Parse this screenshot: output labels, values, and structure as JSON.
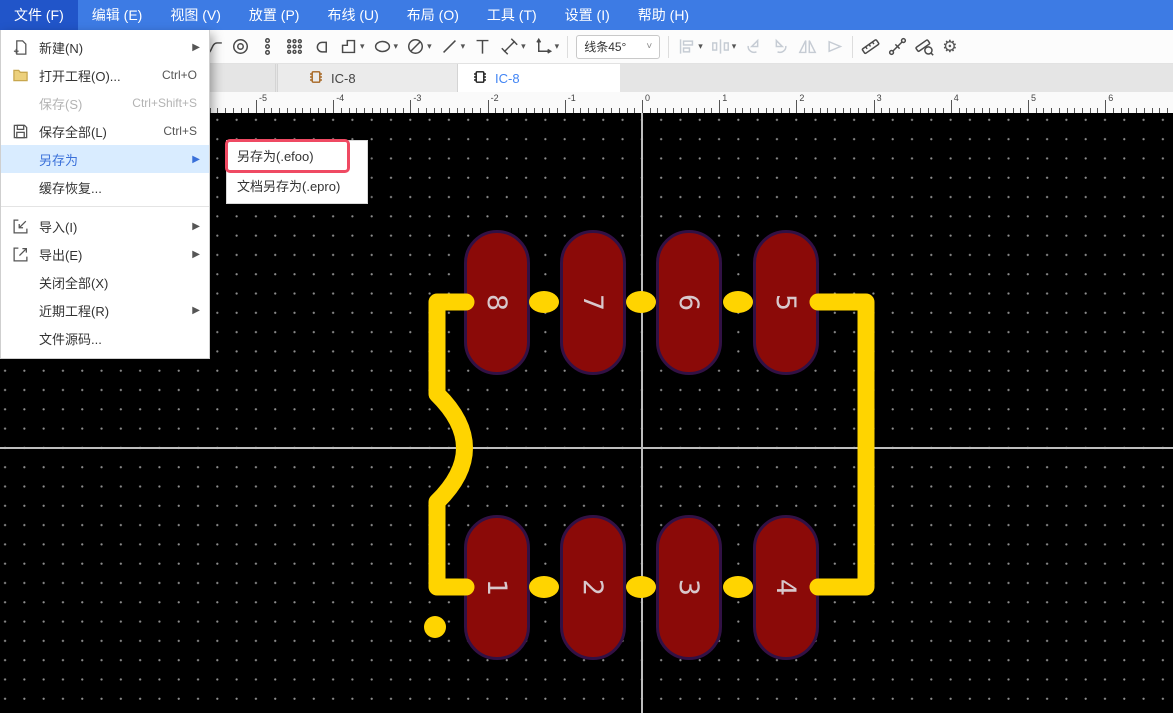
{
  "colors": {
    "menubar_bg": "#3d7be4",
    "menubar_active": "#2155c9",
    "hl_bg": "#d9ecff",
    "hl_text": "#3a70d9",
    "annotation_red": "#ef4a63",
    "tab_active_text": "#4285f4",
    "canvas_bg": "#000000",
    "grid_dot": "#8f8f8f",
    "axis": "#bdbdbd",
    "pad_fill": "#8b0a08",
    "pad_outline": "#321145",
    "pad_number": "#d8c8cc",
    "silkscreen": "#ffd400",
    "folder_fill": "#ecd07c",
    "folder_stroke": "#c8a74e",
    "tab1_icon": "#a5641f",
    "tab2_icon": "#1a1a1a"
  },
  "menu_bar": {
    "active_index": 0,
    "items": [
      "文件 (F)",
      "编辑 (E)",
      "视图 (V)",
      "放置 (P)",
      "布线 (U)",
      "布局 (O)",
      "工具 (T)",
      "设置 (I)",
      "帮助 (H)"
    ]
  },
  "toolbar": {
    "line_mode": "线条45°",
    "tools": [
      {
        "type": "icon",
        "name": "track-icon"
      },
      {
        "type": "icon",
        "name": "via-icon"
      },
      {
        "type": "icon",
        "name": "pad-column-icon"
      },
      {
        "type": "icon",
        "name": "pad-array-icon"
      },
      {
        "type": "icon",
        "name": "pad-shape-icon"
      },
      {
        "type": "icon",
        "name": "polygon-icon",
        "caret": true
      },
      {
        "type": "icon",
        "name": "ellipse-icon",
        "caret": true
      },
      {
        "type": "icon",
        "name": "keepout-icon",
        "caret": true
      },
      {
        "type": "icon",
        "name": "line-icon",
        "caret": true
      },
      {
        "type": "icon",
        "name": "text-icon"
      },
      {
        "type": "icon",
        "name": "dimension-icon",
        "caret": true
      },
      {
        "type": "icon",
        "name": "origin-icon",
        "caret": true
      },
      {
        "type": "separator"
      },
      {
        "type": "select",
        "name": "line-mode-select"
      },
      {
        "type": "separator"
      },
      {
        "type": "icon",
        "name": "align-icon",
        "caret": true,
        "disabled": true
      },
      {
        "type": "icon",
        "name": "distribute-icon",
        "caret": true,
        "disabled": true
      },
      {
        "type": "icon",
        "name": "rotate-left-icon",
        "disabled": true
      },
      {
        "type": "icon",
        "name": "rotate-right-icon",
        "disabled": true
      },
      {
        "type": "icon",
        "name": "flip-horizontal-icon",
        "disabled": true
      },
      {
        "type": "icon",
        "name": "flip-vertical-icon",
        "disabled": true
      },
      {
        "type": "separator"
      },
      {
        "type": "icon",
        "name": "measure-ruler-icon"
      },
      {
        "type": "icon",
        "name": "wire-length-icon"
      },
      {
        "type": "icon",
        "name": "ruler-search-icon"
      },
      {
        "type": "icon",
        "name": "settings-gear-icon"
      }
    ]
  },
  "tab_bar": {
    "tabs": [
      {
        "label": "IC-8",
        "active": false,
        "icon": "footprint-chip-icon"
      },
      {
        "label": "IC-8",
        "active": true,
        "icon": "footprint-chip-icon"
      }
    ]
  },
  "file_menu": {
    "items": [
      {
        "icon": "new-file-icon",
        "label": "新建(N)",
        "arrow": true
      },
      {
        "icon": "folder-icon",
        "label": "打开工程(O)...",
        "shortcut": "Ctrl+O"
      },
      {
        "label": "保存(S)",
        "shortcut": "Ctrl+Shift+S",
        "disabled": true
      },
      {
        "icon": "save-all-icon",
        "label": "保存全部(L)",
        "shortcut": "Ctrl+S"
      },
      {
        "label": "另存为",
        "arrow": true,
        "highlighted": true
      },
      {
        "label": "缓存恢复..."
      },
      {
        "separator": true
      },
      {
        "icon": "import-icon",
        "label": "导入(I)",
        "arrow": true
      },
      {
        "icon": "export-icon",
        "label": "导出(E)",
        "arrow": true
      },
      {
        "label": "关闭全部(X)"
      },
      {
        "label": "近期工程(R)",
        "arrow": true
      },
      {
        "label": "文件源码..."
      }
    ]
  },
  "save_as_submenu": {
    "items": [
      {
        "label": "另存为(.efoo)",
        "annotated": true
      },
      {
        "label": "文档另存为(.epro)",
        "annotated": false
      }
    ]
  },
  "ruler": {
    "unit_labels": [
      "-5",
      "-4",
      "-3",
      "-2",
      "-1",
      "0",
      "1",
      "2",
      "3",
      "4",
      "5",
      "6"
    ]
  },
  "pcb": {
    "pad_numbers_top": [
      "8",
      "7",
      "6",
      "5"
    ],
    "pad_numbers_bottom": [
      "1",
      "2",
      "3",
      "4"
    ]
  }
}
